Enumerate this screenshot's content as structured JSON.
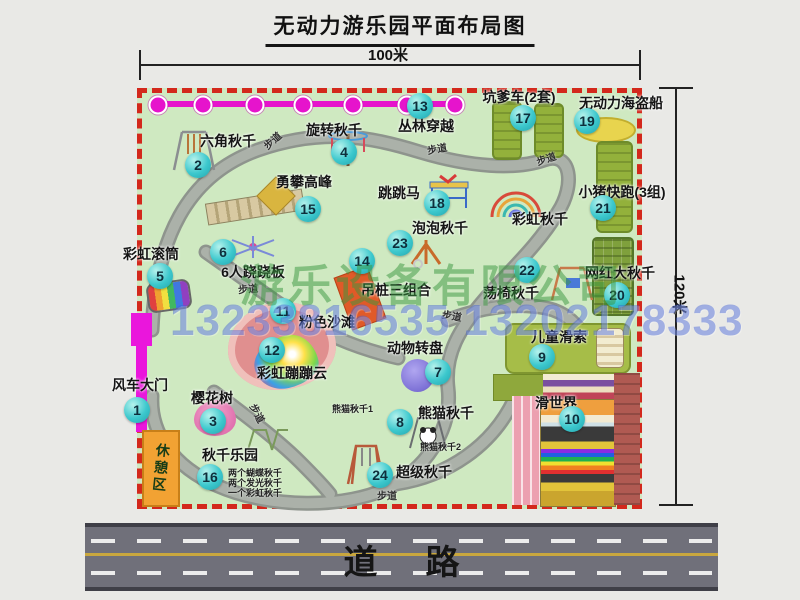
{
  "title": "无动力游乐园平面布局图",
  "dimensions": {
    "width": "100米",
    "height": "120米"
  },
  "road_label": "道路",
  "watermark": {
    "company": "游乐设备有限公司",
    "phone": "13233816535 13202178333"
  },
  "rest_area_label": "休憩区",
  "trail_label": "步道",
  "extra_labels": {
    "rainbow_swing": "彩虹秋千",
    "panda_swing_1": "熊猫秋千1",
    "panda_swing_2": "熊猫秋千2",
    "swing_park_item1": "两个蝴蝶秋千",
    "swing_park_item2": "两个发光秋千",
    "swing_park_item3": "一个彩虹秋千"
  },
  "attractions": [
    {
      "num": "1",
      "label": "风车大门"
    },
    {
      "num": "2",
      "label": "六角秋千"
    },
    {
      "num": "3",
      "label": "樱花树"
    },
    {
      "num": "4",
      "label": "旋转秋千"
    },
    {
      "num": "5",
      "label": "彩虹滚筒"
    },
    {
      "num": "6",
      "label": "6人跷跷板"
    },
    {
      "num": "7",
      "label": "动物转盘"
    },
    {
      "num": "8",
      "label": "熊猫秋千"
    },
    {
      "num": "9",
      "label": "儿童滑索"
    },
    {
      "num": "10",
      "label": "滑世界"
    },
    {
      "num": "11",
      "label": "粉色沙滩"
    },
    {
      "num": "12",
      "label": "彩虹蹦蹦云"
    },
    {
      "num": "13",
      "label": "丛林穿越"
    },
    {
      "num": "14",
      "label": "吊桩三组合"
    },
    {
      "num": "15",
      "label": "勇攀高峰"
    },
    {
      "num": "16",
      "label": "秋千乐园"
    },
    {
      "num": "17",
      "label": "坑爹车(2套)"
    },
    {
      "num": "18",
      "label": "跳跳马"
    },
    {
      "num": "19",
      "label": "无动力海盗船"
    },
    {
      "num": "20",
      "label": "网红大秋千"
    },
    {
      "num": "21",
      "label": "小猪快跑(3组)"
    },
    {
      "num": "22",
      "label": "荡椅秋千"
    },
    {
      "num": "23",
      "label": "泡泡秋千"
    },
    {
      "num": "24",
      "label": "超级秋千"
    }
  ]
}
